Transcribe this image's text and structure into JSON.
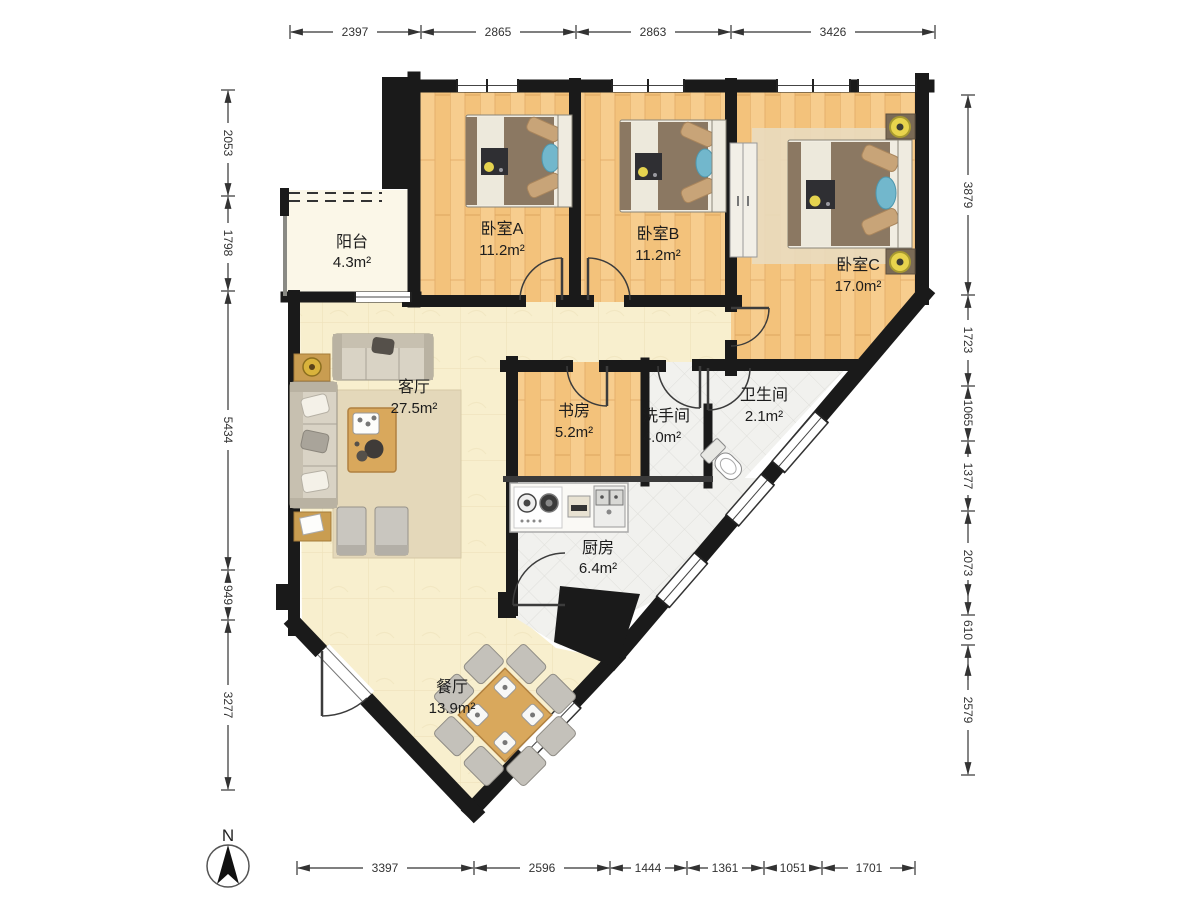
{
  "compass": {
    "label": "N"
  },
  "rooms": {
    "balcony": {
      "name": "阳台",
      "area": "4.3m²"
    },
    "bedroom_a": {
      "name": "卧室A",
      "area": "11.2m²"
    },
    "bedroom_b": {
      "name": "卧室B",
      "area": "11.2m²"
    },
    "bedroom_c": {
      "name": "卧室C",
      "area": "17.0m²"
    },
    "living_room": {
      "name": "客厅",
      "area": "27.5m²"
    },
    "study": {
      "name": "书房",
      "area": "5.2m²"
    },
    "washroom": {
      "name": "洗手间",
      "area": "4.0m²"
    },
    "toilet": {
      "name": "卫生间",
      "area": "2.1m²"
    },
    "kitchen": {
      "name": "厨房",
      "area": "6.4m²"
    },
    "dining_room": {
      "name": "餐厅",
      "area": "13.9m²"
    }
  },
  "dimensions": {
    "top": [
      "2397",
      "2865",
      "2863",
      "3426"
    ],
    "left": [
      "2053",
      "1798",
      "5434",
      "949",
      "3277"
    ],
    "right": [
      "3879",
      "1723",
      "1065",
      "1377",
      "2073",
      "610",
      "2579"
    ],
    "bottom": [
      "3397",
      "2596",
      "1444",
      "1361",
      "1051",
      "1701"
    ]
  },
  "colors": {
    "wall": "#1a1a1a",
    "wood_floor": "#f6c986",
    "cream_floor": "#f8efce",
    "tile_floor": "#f1f1ee",
    "balcony_floor": "#fbf7e8",
    "accent_lamp": "#e8d44d",
    "blanket": "#8b7862",
    "table_wood": "#d9a85c",
    "pillow_blue": "#72b7cc"
  }
}
